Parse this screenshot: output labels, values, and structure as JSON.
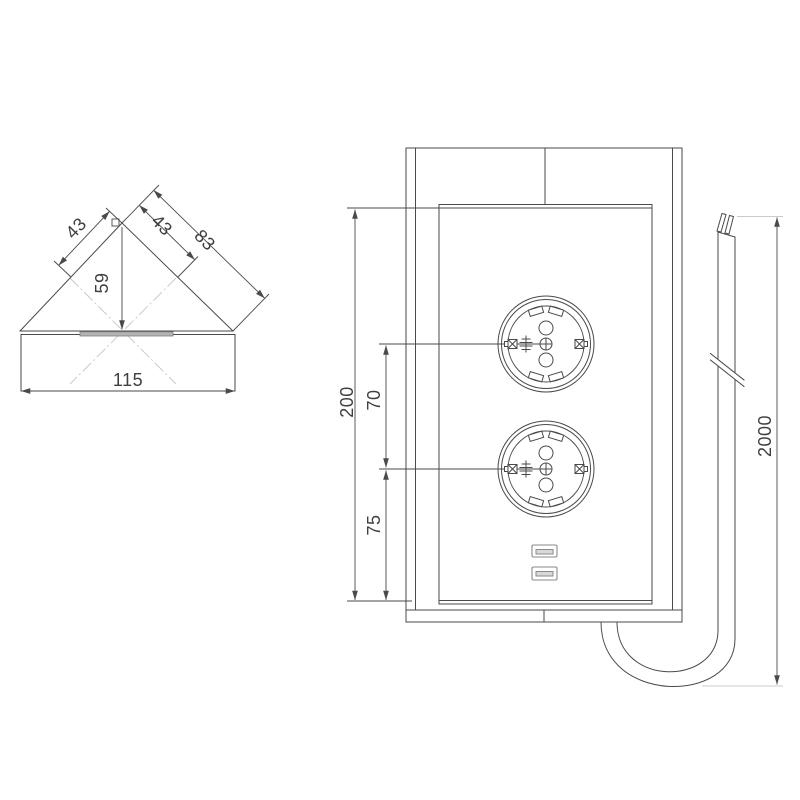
{
  "colors": {
    "line": "#4a4a4a",
    "light": "#cbcbcb",
    "text": "#3f3f3f"
  },
  "views": {
    "top": {
      "face_left": "43",
      "face_right": "43",
      "edge_right": "83",
      "depth": "59",
      "width": "115"
    },
    "front": {
      "height": "200",
      "socket_spacing": "70",
      "socket_bottom": "75"
    },
    "cable": {
      "length": "2000"
    }
  }
}
